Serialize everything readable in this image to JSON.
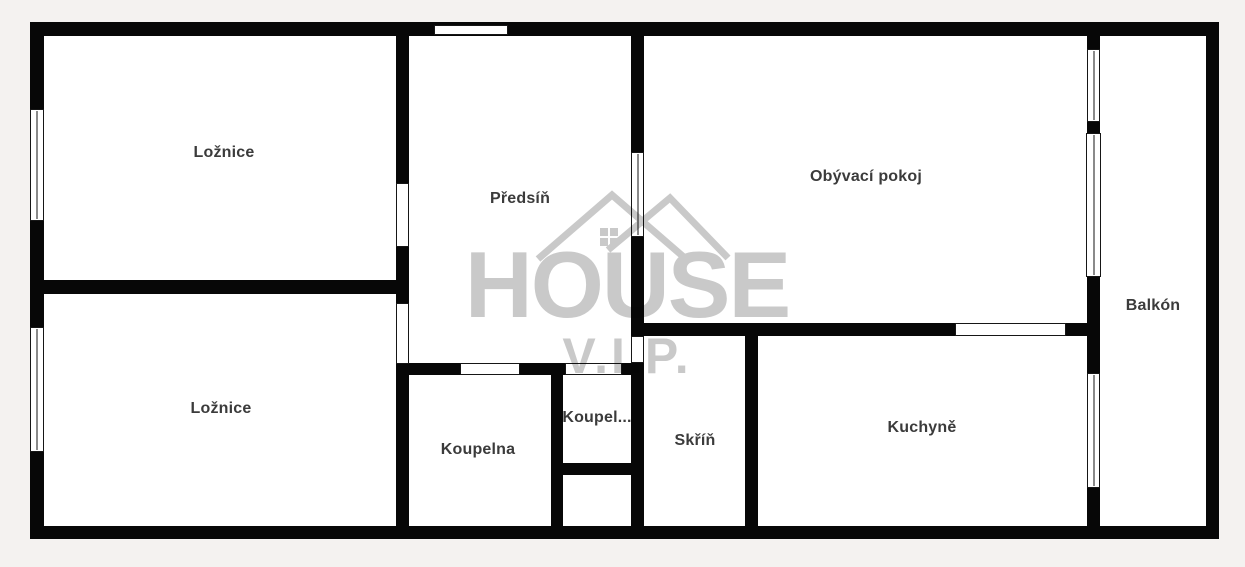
{
  "document": {
    "kind": "apartment floor plan"
  },
  "rooms": [
    {
      "id": "loznice-top",
      "label": "Ložnice"
    },
    {
      "id": "loznice-bottom",
      "label": "Ložnice"
    },
    {
      "id": "predsin",
      "label": "Předsíň"
    },
    {
      "id": "obyvaci-pokoj",
      "label": "Obývací pokoj"
    },
    {
      "id": "balkon",
      "label": "Balkón"
    },
    {
      "id": "koupelna",
      "label": "Koupelna"
    },
    {
      "id": "koupel-truncated",
      "label": "Koupel..."
    },
    {
      "id": "skrin",
      "label": "Skříň"
    },
    {
      "id": "kuchyne",
      "label": "Kuchyně"
    }
  ],
  "watermark": {
    "brand": "HOUSE",
    "sub": "V.I.P.",
    "icon": "house-roof-icon",
    "color": "#c9c9c9"
  },
  "colors": {
    "background": "#f4f2f0",
    "wall": "#070707",
    "room_fill": "#ffffff",
    "label_text": "#3b3b3b"
  }
}
